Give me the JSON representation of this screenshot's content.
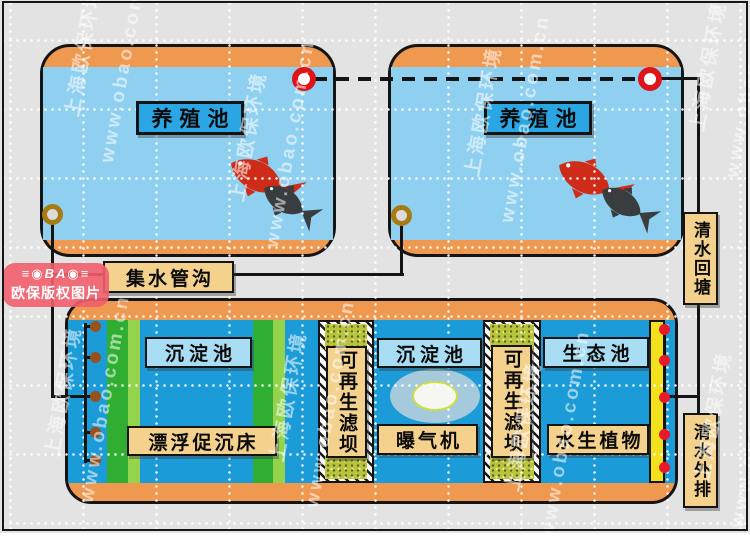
{
  "watermark": {
    "company": "上海欧保环境",
    "site": "www.obao.com.cn"
  },
  "copyright_badge": {
    "logo_mark": "≡◉BA◉≡",
    "text": "欧保版权图片"
  },
  "breeding_ponds": [
    {
      "label": "养殖池"
    },
    {
      "label": "养殖池"
    }
  ],
  "flows": {
    "collector_label": "集水管沟",
    "return_label": "清水回塘",
    "discharge_label": "清水外排"
  },
  "treatment_tank": {
    "sedimentation_label_1": "沉淀池",
    "floating_bed_label": "漂浮促沉床",
    "filter_dam_label_1": "可再生滤坝",
    "sedimentation_label_2": "沉淀池",
    "aerator_label": "曝气机",
    "filter_dam_label_2": "可再生滤坝",
    "ecological_pond_label": "生态池",
    "aquatic_plants_label": "水生植物"
  },
  "colors": {
    "orange": "#ef9850",
    "water_light": "#8fd0f0",
    "water_deep": "#1b9bd7",
    "label_blue": "#2ba6e4",
    "label_lightblue": "#a9ddf3",
    "tan": "#f4d28e",
    "green_dark": "#2fae32",
    "green_light": "#93d44c",
    "yellow": "#f4e11e",
    "ring_red": "#dd1418",
    "ring_olive": "#a87a12",
    "dot_brown": "#96511c",
    "dot_red": "#e61a28",
    "badge_pink": "#f15e6c"
  }
}
